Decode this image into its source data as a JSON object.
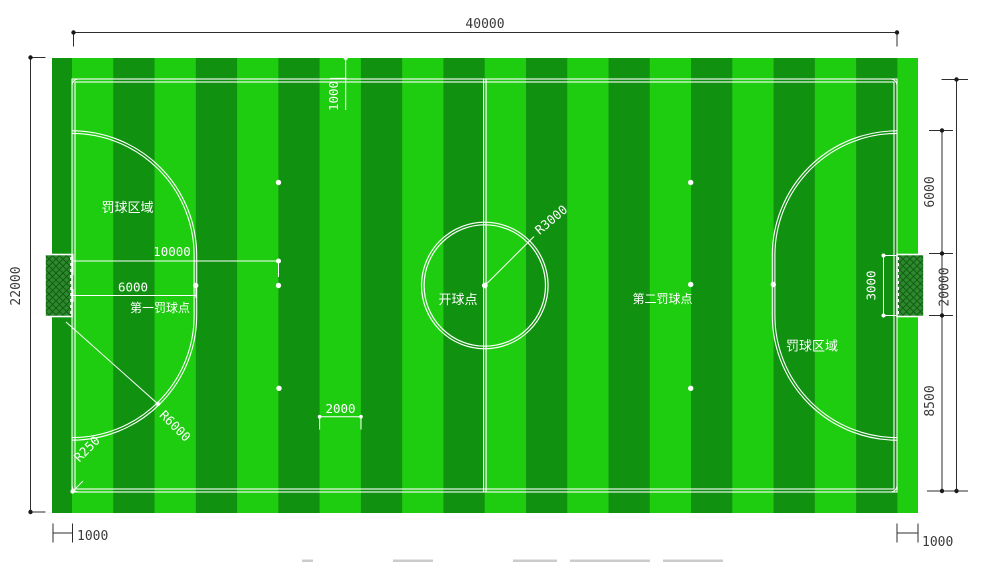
{
  "colors": {
    "page_bg": "#ffffff",
    "stripe_bright": "#1ecd10",
    "stripe_dark": "#119110",
    "line_white": "#ffffff",
    "dim_dark": "#2e2e2e",
    "goal_fill": "#2c8a2c",
    "goal_hatch": "#145c14",
    "caption_smudge": "#cccccc"
  },
  "dimensions": {
    "pitch_length": "40000",
    "field_total_width": "22000",
    "arc_above_post": "6000",
    "pitch_width": "20000",
    "post_to_endline": "8500",
    "goal_width": "3000",
    "margin_top": "1000",
    "margin_left": "1000",
    "margin_right": "1000",
    "second_penalty_distance": "10000",
    "first_penalty_distance": "6000",
    "stripe_width": "2000",
    "center_circle_radius": "R3000",
    "penalty_arc_radius": "R6000",
    "corner_arc_radius": "R250"
  },
  "labels": {
    "penalty_area_left": "罚球区域",
    "penalty_area_right": "罚球区域",
    "first_penalty_point": "第一罚球点",
    "second_penalty_point": "第二罚球点",
    "kickoff_point": "开球点"
  }
}
